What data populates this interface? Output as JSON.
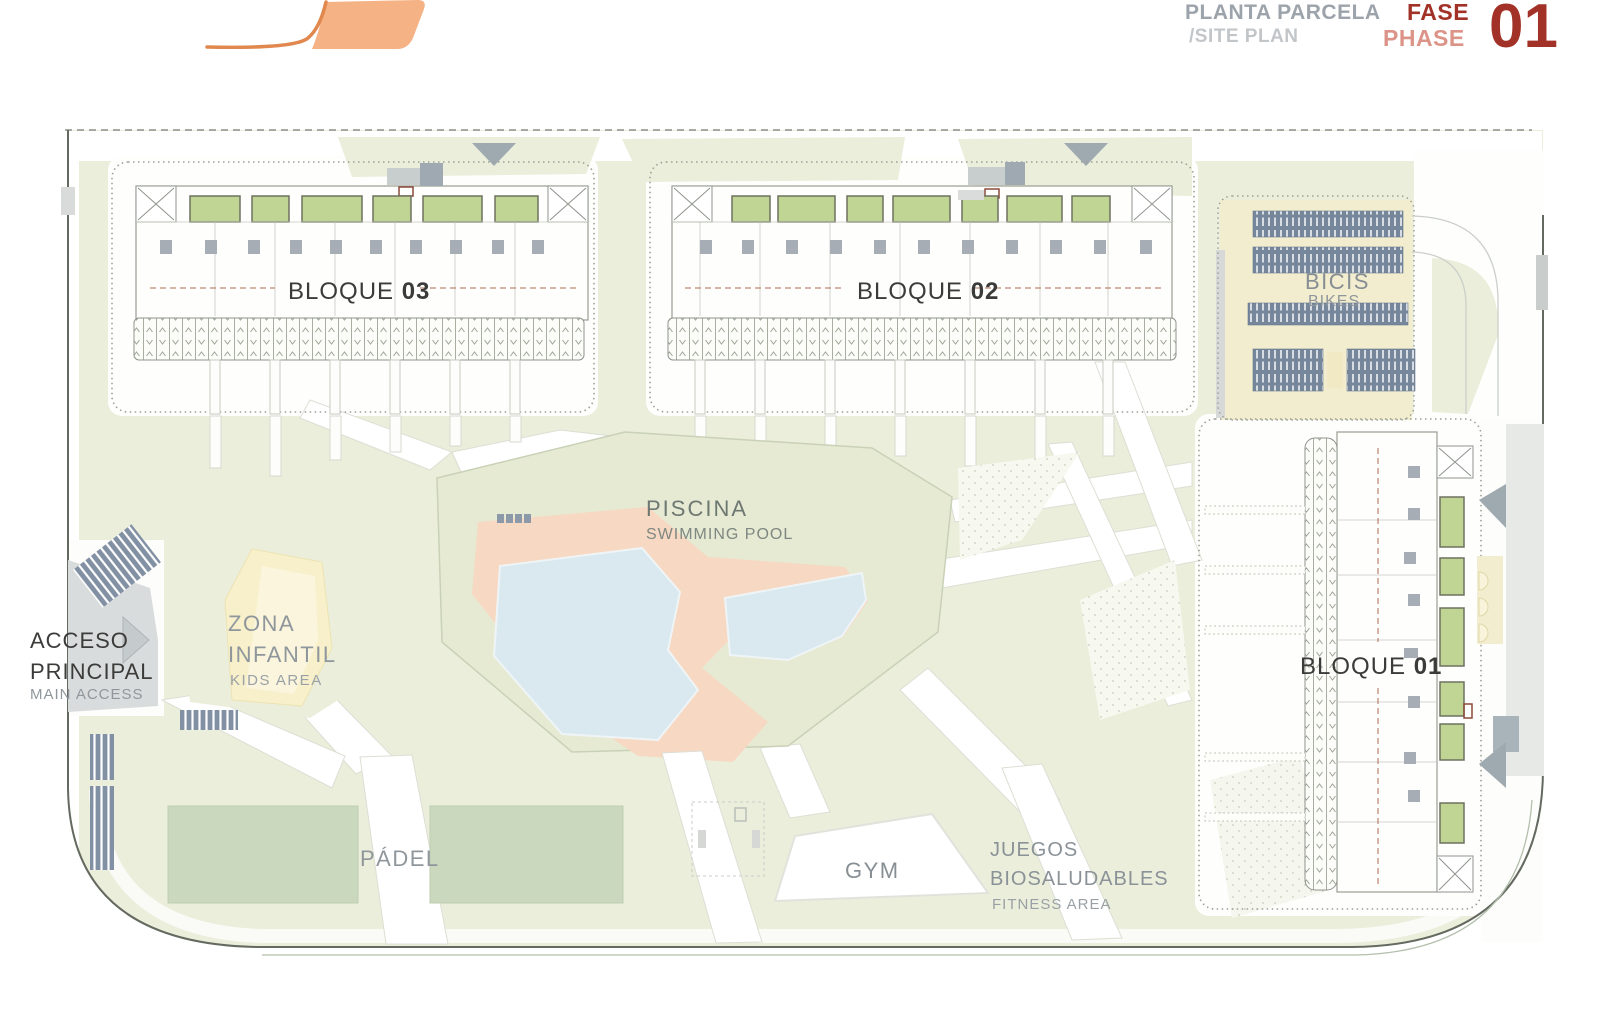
{
  "header": {
    "title": "PLANTA PARCELA",
    "subtitle": "/SITE PLAN",
    "fase": "FASE",
    "phase": "PHASE",
    "phase_number": "01",
    "colors": {
      "title_gray": "#9CA3AA",
      "subtitle_gray": "#C2C6C9",
      "accent_red": "#A23227",
      "accent_red_light": "#DC9488",
      "logo_orange": "#F5B285",
      "logo_stroke": "#E0884E"
    }
  },
  "plan": {
    "blocks": [
      {
        "label": "BLOQUE",
        "number": "03"
      },
      {
        "label": "BLOQUE",
        "number": "02"
      },
      {
        "label": "BLOQUE",
        "number": "01"
      }
    ],
    "areas": {
      "bikes": {
        "label": "BICIS",
        "sublabel": "BIKES"
      },
      "pool": {
        "label": "PISCINA",
        "sublabel": "SWIMMING POOL"
      },
      "kids": {
        "label_line1": "ZONA",
        "label_line2": "INFANTIL",
        "sublabel": "KIDS AREA"
      },
      "access": {
        "label_line1": "ACCESO",
        "label_line2": "PRINCIPAL",
        "sublabel": "MAIN ACCESS"
      },
      "padel": {
        "label": "PÁDEL"
      },
      "gym": {
        "label": "GYM"
      },
      "fitness": {
        "label_line1": "JUEGOS",
        "label_line2": "BIOSALUDABLES",
        "sublabel": "FITNESS AREA"
      }
    },
    "colors": {
      "lawn": "#EBEEDB",
      "pool_lawn": "#E6EAD3",
      "court_green": "#CAD8BE",
      "garden_green": "#C0D493",
      "pool_blue": "#D9E9EF",
      "deck_salmon": "#F7D8C2",
      "cream": "#F3EDCF",
      "slate": "#76869B",
      "road_gray": "#D9DCDC",
      "boundary": "#656A60",
      "label_dark": "#3B3B3A",
      "label_gray": "#8F979C"
    }
  }
}
